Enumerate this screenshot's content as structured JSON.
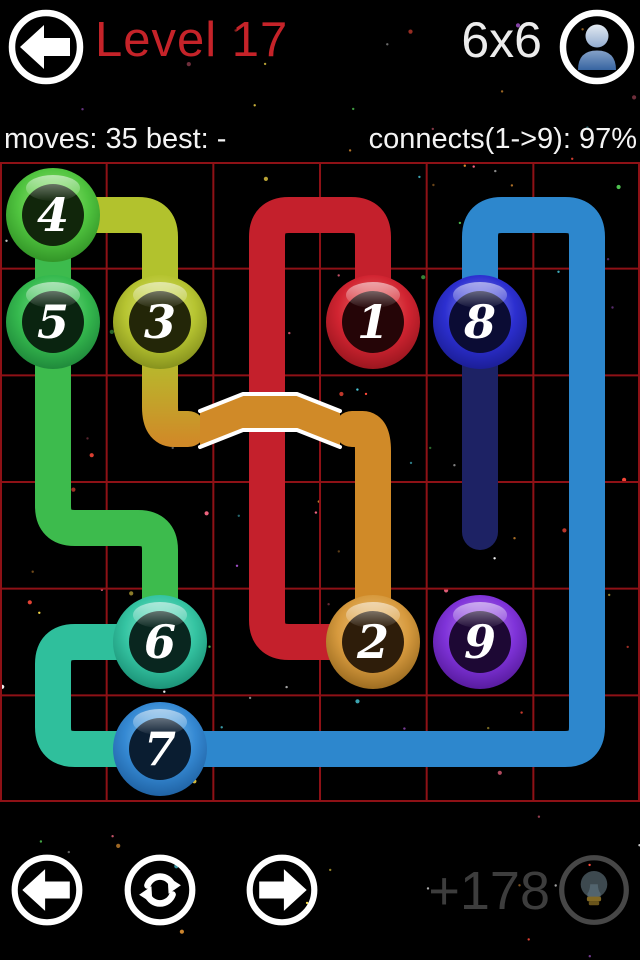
{
  "header": {
    "title": "Level 17",
    "grid_size": "6x6",
    "back_icon": "arrow-left",
    "profile_icon": "person"
  },
  "stats": {
    "moves_best": "moves: 35 best: -",
    "connects": "connects(1->9): 97%"
  },
  "footer": {
    "bonus": "+178",
    "prev_icon": "arrow-left",
    "restart_icon": "refresh",
    "next_icon": "arrow-right",
    "hint_icon": "lightbulb"
  },
  "board": {
    "rows": 6,
    "cols": 6,
    "top": 162,
    "size": 640,
    "cell": 106.67,
    "grid_color": "#8e1116",
    "pipe_width": 36,
    "corner_radius": 22,
    "paths": [
      {
        "name": "path-1-2",
        "color": "#c4202c",
        "points": [
          [
            373,
            322
          ],
          [
            373,
            215
          ],
          [
            267,
            215
          ],
          [
            267,
            642
          ],
          [
            373,
            642
          ]
        ]
      },
      {
        "name": "path-2-3-orange",
        "color": "#d08a28",
        "points": [
          [
            373,
            642
          ],
          [
            373,
            429
          ],
          [
            352,
            429
          ]
        ]
      },
      {
        "name": "path-2-3-gradient",
        "gradient": {
          "from": "#d08a28",
          "to": "#b2c22d",
          "x1": 160,
          "y1": 442,
          "x2": 160,
          "y2": 348
        },
        "points": [
          [
            188,
            429
          ],
          [
            160,
            429
          ],
          [
            160,
            322
          ]
        ]
      },
      {
        "name": "path-3-4",
        "color": "#b2c22d",
        "points": [
          [
            160,
            322
          ],
          [
            160,
            215
          ],
          [
            53,
            215
          ]
        ]
      },
      {
        "name": "path-4-5",
        "color": "#3dbb4d",
        "points": [
          [
            53,
            215
          ],
          [
            53,
            322
          ]
        ]
      },
      {
        "name": "path-5-6",
        "color": "#3dbb4d",
        "points": [
          [
            53,
            322
          ],
          [
            53,
            528
          ],
          [
            160,
            528
          ],
          [
            160,
            642
          ]
        ]
      },
      {
        "name": "path-6-7",
        "color": "#2fbf9c",
        "points": [
          [
            160,
            642
          ],
          [
            53,
            642
          ],
          [
            53,
            749
          ],
          [
            160,
            749
          ]
        ]
      },
      {
        "name": "path-7-8",
        "color": "#2d87cd",
        "points": [
          [
            160,
            749
          ],
          [
            587,
            749
          ],
          [
            587,
            215
          ],
          [
            480,
            215
          ],
          [
            480,
            322
          ]
        ]
      },
      {
        "name": "path-8-loose-end",
        "color": "#1d2264",
        "points": [
          [
            480,
            322
          ],
          [
            480,
            532
          ]
        ]
      }
    ],
    "bridge": {
      "fill": "#d08a28",
      "line_color": "#ffffff",
      "polygon": [
        [
          200,
          411
        ],
        [
          243,
          394
        ],
        [
          297,
          394
        ],
        [
          340,
          411
        ],
        [
          340,
          447
        ],
        [
          297,
          430
        ],
        [
          243,
          430
        ],
        [
          200,
          447
        ]
      ],
      "top_line": [
        [
          200,
          411
        ],
        [
          243,
          394
        ],
        [
          297,
          394
        ],
        [
          340,
          411
        ]
      ],
      "bottom_line": [
        [
          200,
          447
        ],
        [
          243,
          430
        ],
        [
          297,
          430
        ],
        [
          340,
          447
        ]
      ]
    },
    "nodes": [
      {
        "label": "1",
        "x": 373,
        "y": 322,
        "light": "#f07a72",
        "base": "#d12431",
        "dark": "#7e0f16",
        "inner": "#250507"
      },
      {
        "label": "2",
        "x": 373,
        "y": 642,
        "light": "#f2cd8c",
        "base": "#d79a3e",
        "dark": "#7e5512",
        "inner": "#2e1d0a"
      },
      {
        "label": "3",
        "x": 160,
        "y": 322,
        "light": "#dfe87c",
        "base": "#b6c431",
        "dark": "#6d7713",
        "inner": "#232608"
      },
      {
        "label": "4",
        "x": 53,
        "y": 215,
        "light": "#a2ea80",
        "base": "#50c43f",
        "dark": "#237c1b",
        "inner": "#11260b"
      },
      {
        "label": "5",
        "x": 53,
        "y": 322,
        "light": "#8ae398",
        "base": "#35b94e",
        "dark": "#147031",
        "inner": "#0a2410"
      },
      {
        "label": "6",
        "x": 160,
        "y": 642,
        "light": "#90ecd2",
        "base": "#35c4a2",
        "dark": "#0f7a62",
        "inner": "#09261f"
      },
      {
        "label": "7",
        "x": 160,
        "y": 749,
        "light": "#8ccaf2",
        "base": "#3589d3",
        "dark": "#154f8c",
        "inner": "#0a1d31"
      },
      {
        "label": "8",
        "x": 480,
        "y": 322,
        "light": "#9598ee",
        "base": "#2c2fd0",
        "dark": "#131578",
        "inner": "#0b0c34"
      },
      {
        "label": "9",
        "x": 480,
        "y": 642,
        "light": "#bb85ec",
        "base": "#7f33d9",
        "dark": "#440f80",
        "inner": "#1d0834"
      }
    ],
    "number_color": "#ffffff"
  }
}
